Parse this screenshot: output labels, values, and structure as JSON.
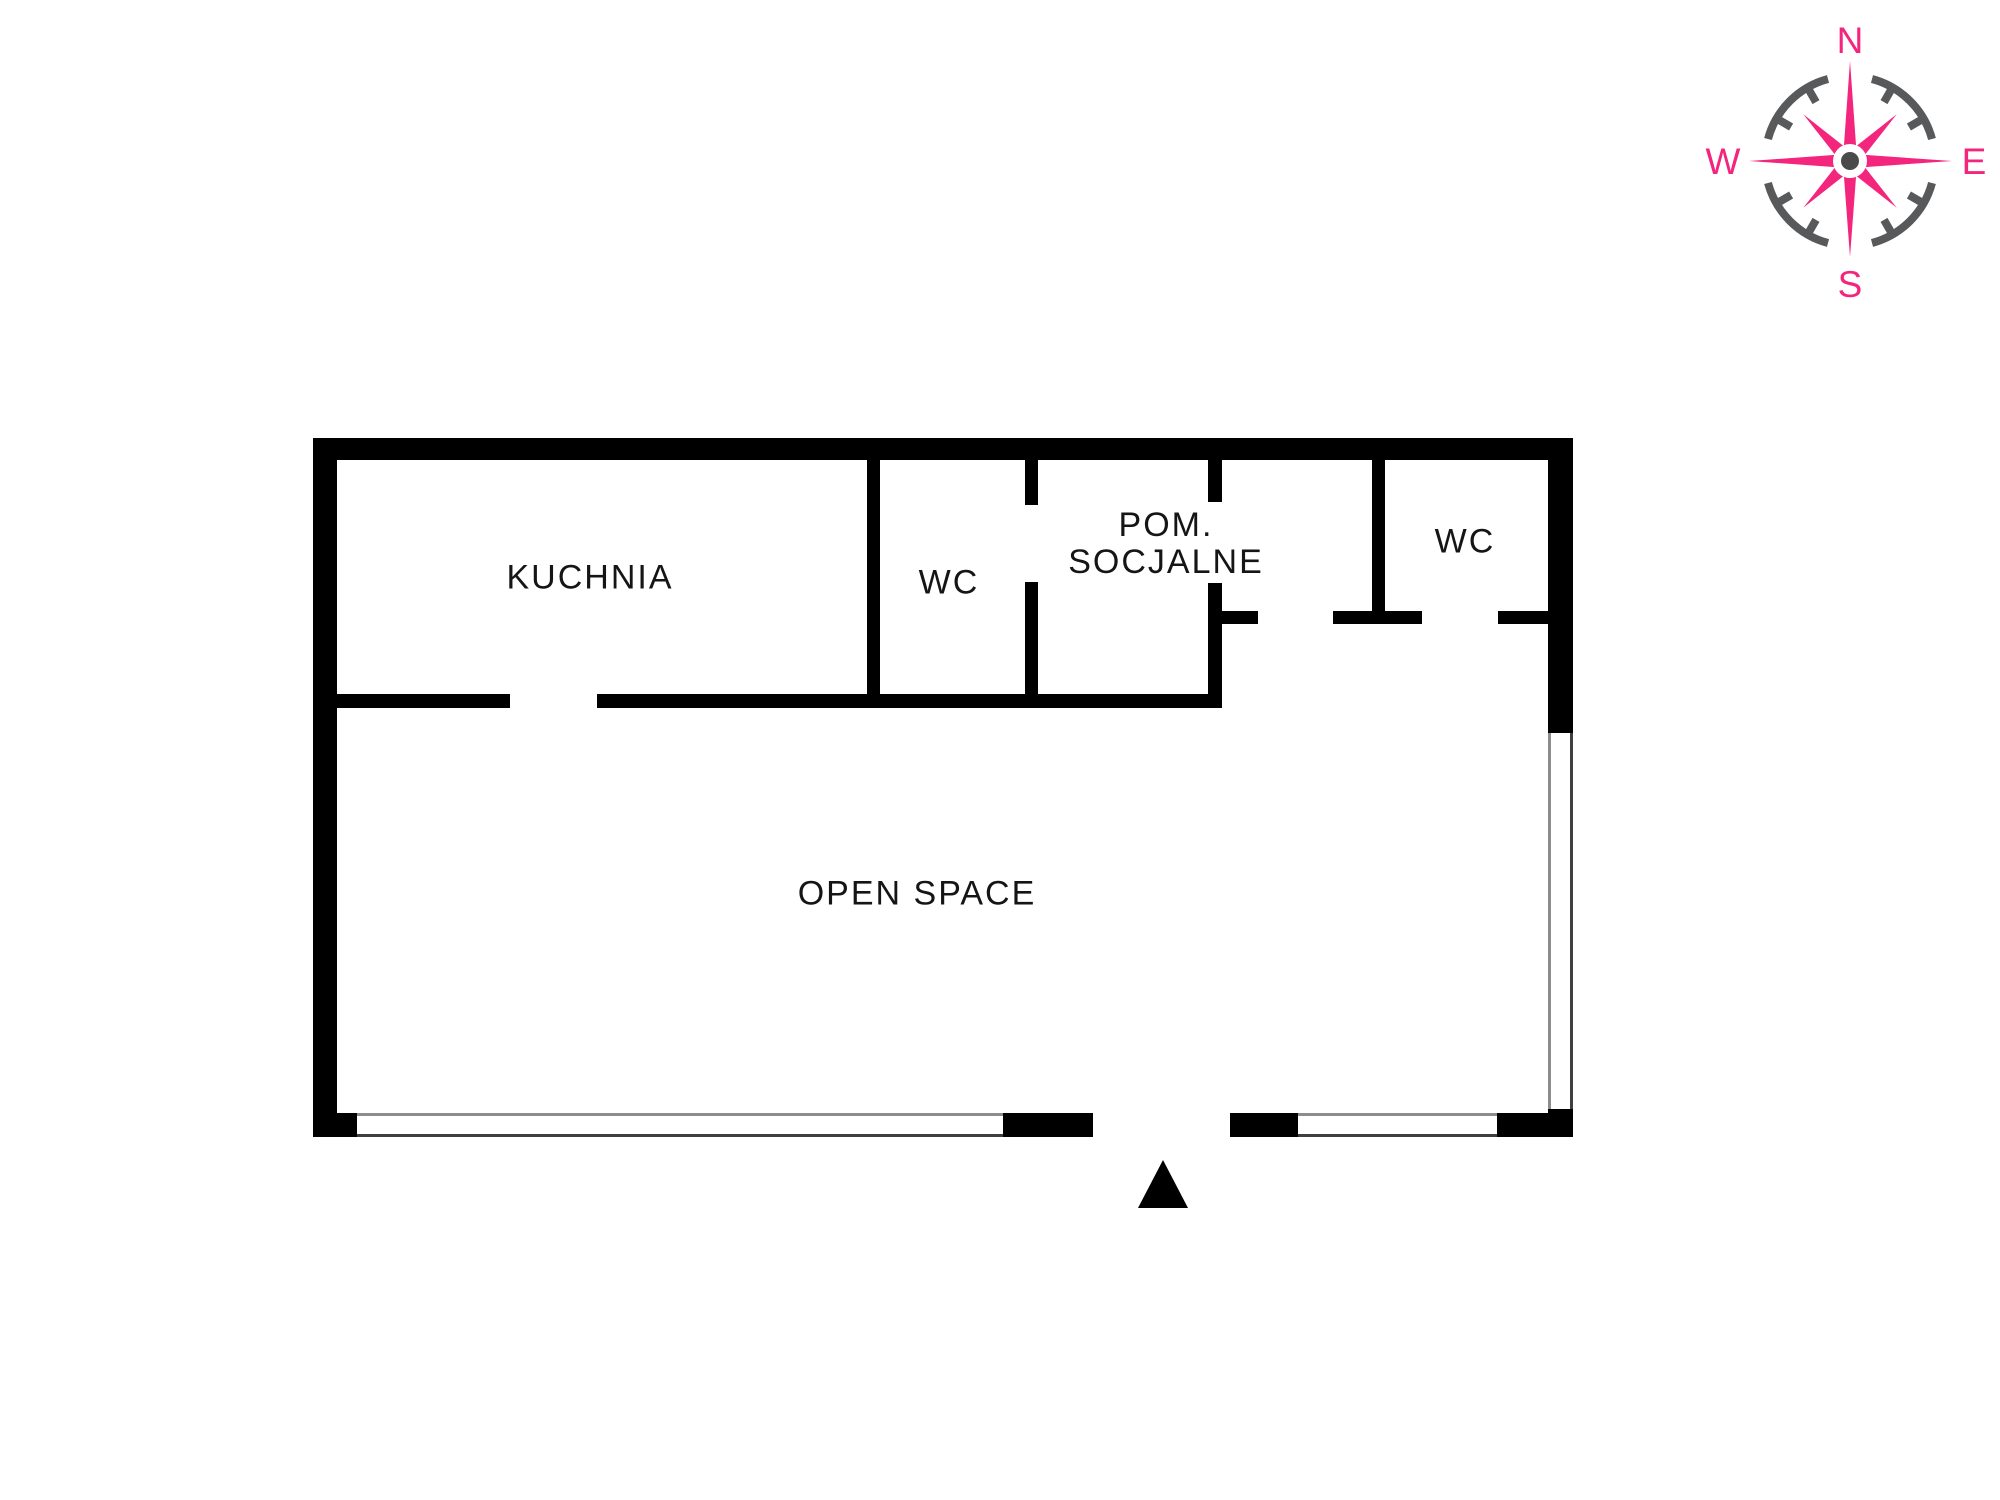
{
  "colors": {
    "background": "#ffffff",
    "wall": "#000000",
    "window-frame": "#8c8c8c",
    "window-frame-dark": "#3f3f3f",
    "text": "#151515",
    "compass-rose": "#F4257D",
    "compass-ring": "#58595B"
  },
  "compass": {
    "north": "N",
    "south": "S",
    "east": "E",
    "west": "W"
  },
  "floor_plan": {
    "rooms": [
      {
        "id": "kuchnia",
        "label": "KUCHNIA"
      },
      {
        "id": "wc-1",
        "label": "WC"
      },
      {
        "id": "pom-socjalne",
        "label_line1": "POM.",
        "label_line2": "SOCJALNE"
      },
      {
        "id": "wc-2",
        "label": "WC"
      },
      {
        "id": "open-space",
        "label": "OPEN SPACE"
      }
    ]
  }
}
